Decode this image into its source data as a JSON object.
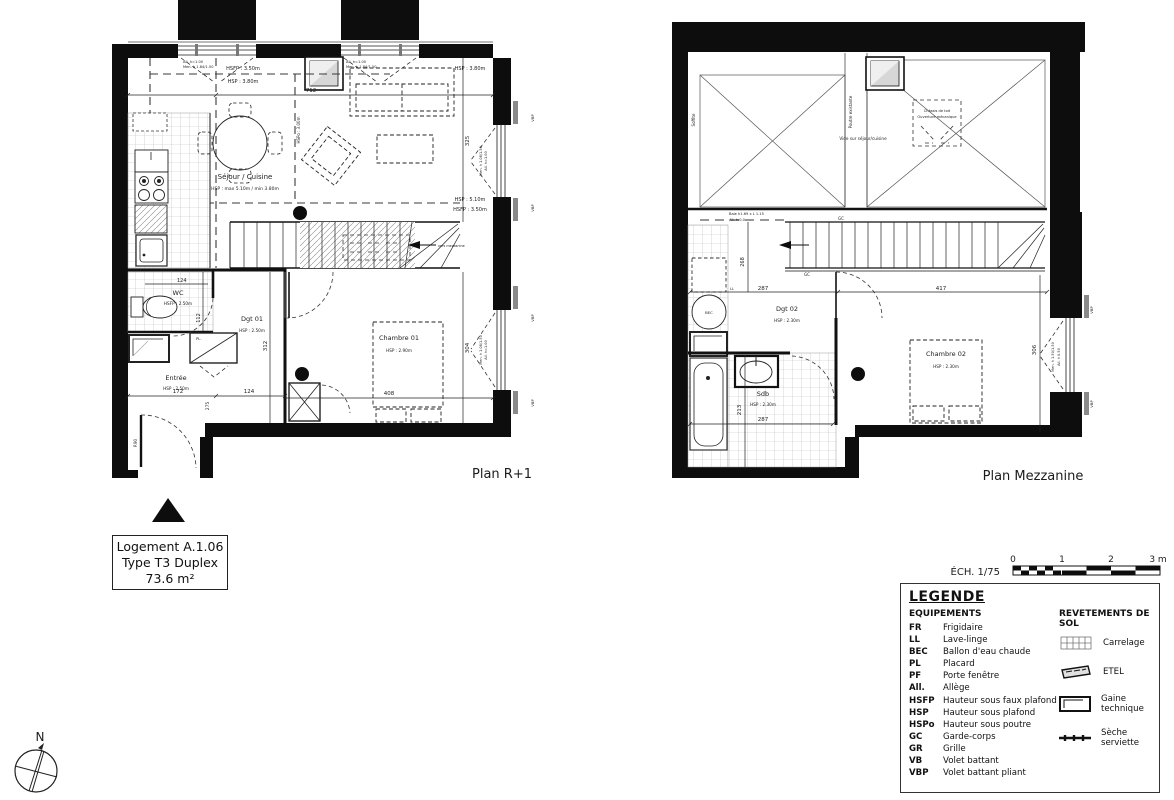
{
  "tb": {
    "l1": "Logement A.1.06",
    "l2": "Type T3 Duplex",
    "l3": "73.6 m²"
  },
  "cp": {
    "n": "N"
  },
  "sc": {
    "label": "ÉCH. 1/75",
    "t0": "0",
    "t1": "1",
    "t2": "2",
    "t3": "3 m"
  },
  "r1": {
    "caption": "Plan R+1",
    "sejour": "Séjour / Cuisine",
    "sejour_note": "HSP : max 5.10m / min 3.80m",
    "wc": "WC",
    "wc_note": "HSFP : 2.50m",
    "entree": "Entrée",
    "entree_note": "HSP : 2.50m",
    "dgt": "Dgt 01",
    "dgt_note": "HSP : 2.50m",
    "ch": "Chambre 01",
    "ch_note": "HSP : 2.90m",
    "hsfp_a": "HSFP : 3.50m",
    "hsp_a": "HSP : 3.80m",
    "hsp_b": "HSP : 3.80m",
    "hspo": "HSPo : 3.00m",
    "hsp_c": "HSP : 5.10m",
    "hsfp_c": "HSFP : 3.50m",
    "vers": "vers mezzanine",
    "pl": "PL.",
    "p90": "P.90",
    "d712": "712",
    "d325": "325",
    "d304": "304",
    "d312": "312",
    "d112": "112",
    "d124a": "124",
    "d172": "172",
    "d124b": "124",
    "d275": "275",
    "d408": "408",
    "wn1a": "All. h=1.00",
    "wn1b": "Men. h 1.84/1.50",
    "wn2a": "All. h=1.00",
    "wn2b": "Men. h 1.84/1.50",
    "wnra": "All. h=1.00",
    "wnrb": "Men. h 1.08/1.50",
    "vbp": "VBP"
  },
  "mz": {
    "caption": "Plan Mezzanine",
    "soffite": "Soffite",
    "poutre": "Poutre existante",
    "vide": "Vide sur séjour/cuisine",
    "chassis1": "Châssis de toit",
    "chassis2": "Ouverture mécanique",
    "baie1": "Baie h1.69 x L 1.15",
    "baie2": "All. h:0.0",
    "gc": "GC",
    "dgt": "Dgt 02",
    "dgt_note": "HSP : 2.30m",
    "sdb": "Sdb",
    "sdb_note": "HSP : 2.30m",
    "ch": "Chambre 02",
    "ch_note": "HSP : 2.30m",
    "bec": "BEC",
    "ll": "LL",
    "d287a": "287",
    "d417": "417",
    "d268": "268",
    "d306": "306",
    "d213": "213",
    "d287b": "287",
    "wna": "All. h 0.50",
    "wnb": "Men. h 1.50/1.50",
    "vbp": "VBP"
  },
  "lg": {
    "title": "LEGENDE",
    "equip": "EQUIPEMENTS",
    "floor": "REVETEMENTS DE SOL",
    "items": [
      {
        "abbr": "FR",
        "label": "Frigidaire"
      },
      {
        "abbr": "LL",
        "label": "Lave-linge"
      },
      {
        "abbr": "BEC",
        "label": "Ballon d'eau chaude"
      },
      {
        "abbr": "PL",
        "label": "Placard"
      },
      {
        "abbr": "PF",
        "label": "Porte fenêtre"
      },
      {
        "abbr": "All.",
        "label": "Allège"
      },
      {
        "abbr": "HSFP",
        "label": "Hauteur sous faux plafond"
      },
      {
        "abbr": "HSP",
        "label": "Hauteur sous plafond"
      },
      {
        "abbr": "HSPo",
        "label": "Hauteur sous poutre"
      },
      {
        "abbr": "GC",
        "label": "Garde-corps"
      },
      {
        "abbr": "GR",
        "label": "Grille"
      },
      {
        "abbr": "VB",
        "label": "Volet battant"
      },
      {
        "abbr": "VBP",
        "label": "Volet battant pliant"
      }
    ],
    "floor_items": [
      "Carrelage",
      "ETEL",
      "Gaine technique",
      "Sèche serviette"
    ]
  }
}
